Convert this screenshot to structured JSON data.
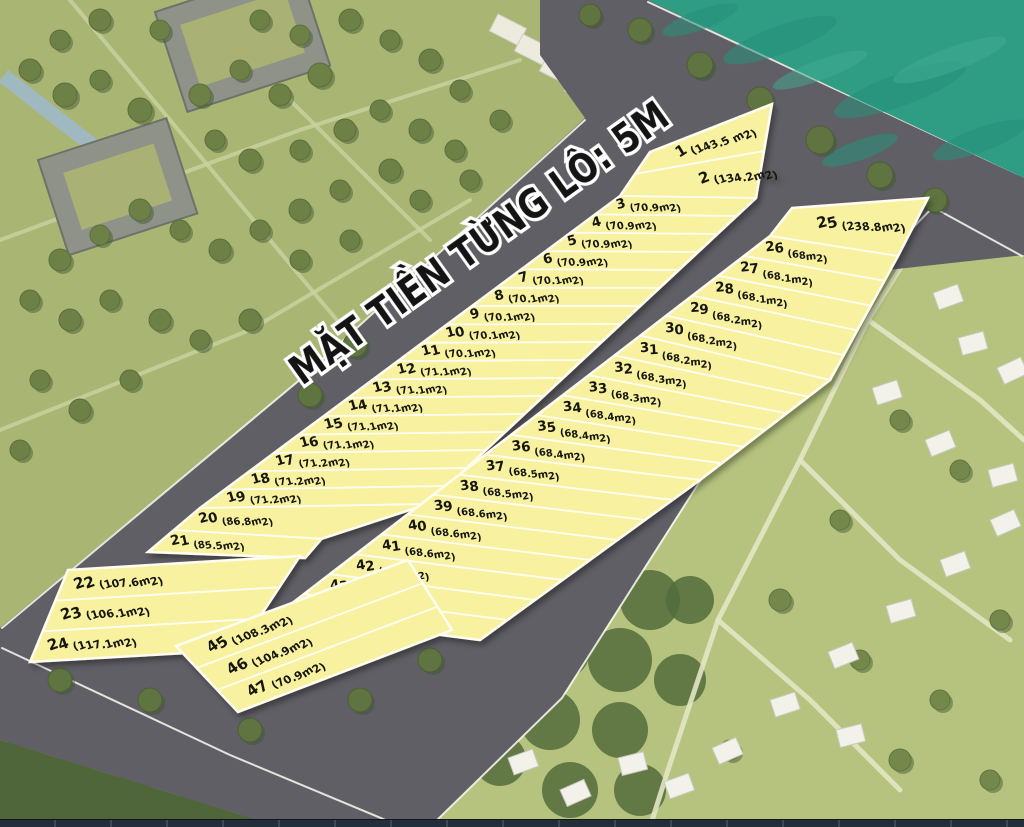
{
  "title": "MẶT TIỀN TỪNG LÔ: 5M",
  "strips": [
    {
      "id": "left-row",
      "plots": [
        {
          "no": "1",
          "area": "(143.5 m2)"
        },
        {
          "no": "2",
          "area": "(134.2m2)"
        },
        {
          "no": "3",
          "area": "(70.9m2)"
        },
        {
          "no": "4",
          "area": "(70.9m2)"
        },
        {
          "no": "5",
          "area": "(70.9m2)"
        },
        {
          "no": "6",
          "area": "(70.9m2)"
        },
        {
          "no": "7",
          "area": "(70.1m2)"
        },
        {
          "no": "8",
          "area": "(70.1m2)"
        },
        {
          "no": "9",
          "area": "(70.1m2)"
        },
        {
          "no": "10",
          "area": "(70.1m2)"
        },
        {
          "no": "11",
          "area": "(70.1m2)"
        },
        {
          "no": "12",
          "area": "(71.1m2)"
        },
        {
          "no": "13",
          "area": "(71.1m2)"
        },
        {
          "no": "14",
          "area": "(71.1m2)"
        },
        {
          "no": "15",
          "area": "(71.1m2)"
        },
        {
          "no": "16",
          "area": "(71.1m2)"
        },
        {
          "no": "17",
          "area": "(71.2m2)"
        },
        {
          "no": "18",
          "area": "(71.2m2)"
        },
        {
          "no": "19",
          "area": "(71.2m2)"
        },
        {
          "no": "20",
          "area": "(86.8m2)"
        },
        {
          "no": "21",
          "area": "(85.5m2)"
        },
        {
          "no": "22",
          "area": "(107.6m2)"
        },
        {
          "no": "23",
          "area": "(106.1m2)"
        },
        {
          "no": "24",
          "area": "(117.1m2)"
        }
      ]
    },
    {
      "id": "right-row",
      "plots": [
        {
          "no": "25",
          "area": "(238.8m2)"
        },
        {
          "no": "26",
          "area": "(68m2)"
        },
        {
          "no": "27",
          "area": "(68.1m2)"
        },
        {
          "no": "28",
          "area": "(68.1m2)"
        },
        {
          "no": "29",
          "area": "(68.2m2)"
        },
        {
          "no": "30",
          "area": "(68.2m2)"
        },
        {
          "no": "31",
          "area": "(68.2m2)"
        },
        {
          "no": "32",
          "area": "(68.3m2)"
        },
        {
          "no": "33",
          "area": "(68.3m2)"
        },
        {
          "no": "34",
          "area": "(68.4m2)"
        },
        {
          "no": "35",
          "area": "(68.4m2)"
        },
        {
          "no": "36",
          "area": "(68.4m2)"
        },
        {
          "no": "37",
          "area": "(68.5m2)"
        },
        {
          "no": "38",
          "area": "(68.5m2)"
        },
        {
          "no": "39",
          "area": "(68.6m2)"
        },
        {
          "no": "40",
          "area": "(68.6m2)"
        },
        {
          "no": "41",
          "area": "(68.6m2)"
        },
        {
          "no": "42",
          "area": "(68.7m2)"
        },
        {
          "no": "43",
          "area": "(68.7m2)"
        },
        {
          "no": "44",
          "area": "(68.7m2)"
        }
      ]
    },
    {
      "id": "bottom-block",
      "plots": [
        {
          "no": "45",
          "area": "(108.3m2)"
        },
        {
          "no": "46",
          "area": "(104.9m2)"
        },
        {
          "no": "47",
          "area": "(70.9m2)"
        }
      ]
    }
  ],
  "colors": {
    "water": "#2f9c84",
    "road": "#605f65",
    "grass": "#a9b573",
    "hill": "#b5c37e",
    "forest": "#4e663a",
    "plot_fill": "#f7f1a0",
    "plot_border": "#fffdf0",
    "label_text": "#17170f",
    "edge_line": "#fbfaf2"
  }
}
